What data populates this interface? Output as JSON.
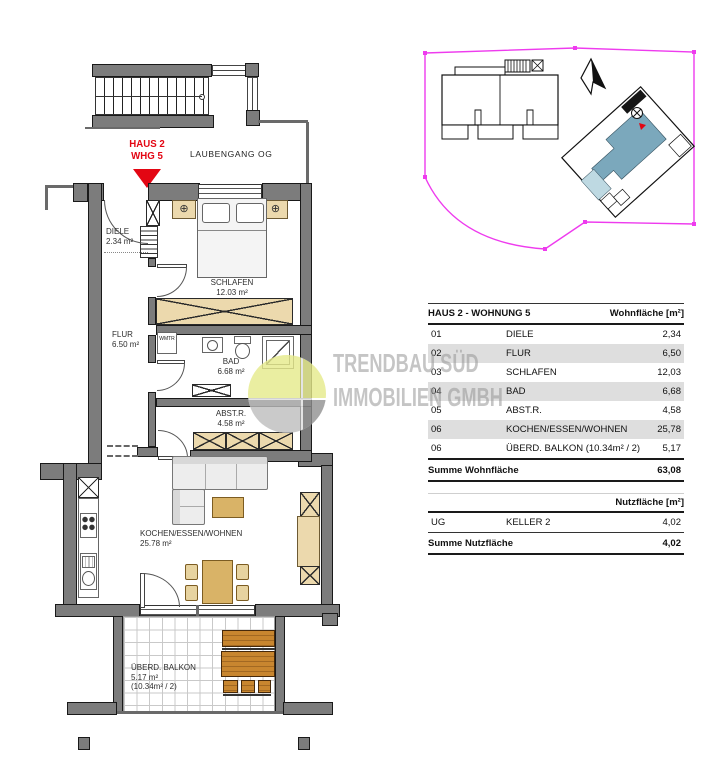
{
  "marker": {
    "line1": "HAUS 2",
    "line2": "WHG 5"
  },
  "plan": {
    "laubengang_label": "LAUBENGANG OG",
    "rooms": {
      "diele": {
        "name": "DIELE",
        "area": "2.34 m²"
      },
      "flur": {
        "name": "FLUR",
        "area": "6.50 m²"
      },
      "schlafen": {
        "name": "SCHLAFEN",
        "area": "12.03 m²"
      },
      "bad": {
        "name": "BAD",
        "area": "6.68 m²"
      },
      "abstr": {
        "name": "ABST.R.",
        "area": "4.58 m²"
      },
      "wohnen": {
        "name": "KOCHEN/ESSEN/WOHNEN",
        "area": "25.78 m²"
      },
      "balkon": {
        "name": "ÜBERD. BALKON",
        "area": "5.17 m²",
        "note": "(10.34m² / 2)"
      }
    },
    "wm_closet": {
      "line1": "WM",
      "line2": "TR"
    }
  },
  "watermark": {
    "line1": "TRENDBAU SÜD",
    "line2": "IMMOBILIEN GMBH"
  },
  "area_table": {
    "title": "HAUS 2 - WOHNUNG 5",
    "col_header": "Wohnfläche [m²]",
    "rows": [
      {
        "nr": "01",
        "room": "DIELE",
        "value": "2,34"
      },
      {
        "nr": "02",
        "room": "FLUR",
        "value": "6,50"
      },
      {
        "nr": "03",
        "room": "SCHLAFEN",
        "value": "12,03"
      },
      {
        "nr": "04",
        "room": "BAD",
        "value": "6,68"
      },
      {
        "nr": "05",
        "room": "ABST.R.",
        "value": "4,58"
      },
      {
        "nr": "06",
        "room": "KOCHEN/ESSEN/WOHNEN",
        "value": "25,78"
      },
      {
        "nr": "06",
        "room": "ÜBERD. BALKON (10.34m² / 2)",
        "value": "5,17"
      }
    ],
    "sum_label": "Summe Wohnfläche",
    "sum_value": "63,08"
  },
  "utility_table": {
    "col_header": "Nutzfläche [m²]",
    "row": {
      "nr": "UG",
      "room": "KELLER 2",
      "value": "4,02"
    },
    "sum_label": "Summe Nutzfläche",
    "sum_value": "4,02"
  },
  "colors": {
    "wall_gray": "#7c7c7c",
    "marker_red": "#e30613",
    "site_boundary_magenta": "#ee3bee",
    "unit_highlight_blue": "#7ba8bc",
    "balcony_light_blue": "#bed9e2",
    "furniture_beige": "#ecd9ad",
    "table_tan": "#d9b367",
    "balcony_brown": "#c8862f",
    "row_shading": "#dedede"
  }
}
